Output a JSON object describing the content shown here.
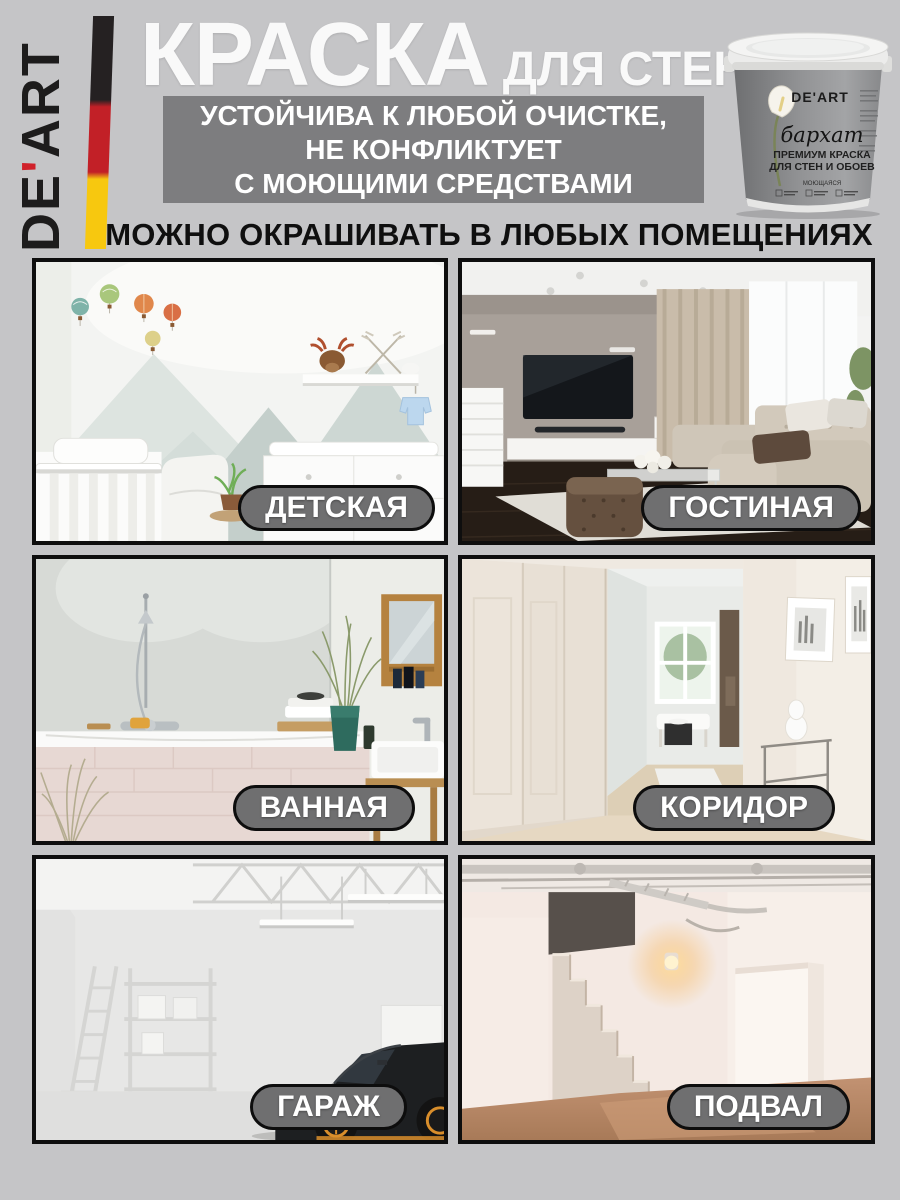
{
  "page": {
    "background": "#c5c5c7"
  },
  "logo": {
    "part1": "DE",
    "apostrophe": "'",
    "part2": "ART",
    "flag_colors": {
      "black": "#252122",
      "red": "#c22027",
      "yellow": "#f7c80f"
    }
  },
  "header": {
    "title": "КРАСКА",
    "title_suffix": "ДЛЯ СТЕН",
    "benefit_box": {
      "background": "#7d7d7f",
      "lines": [
        "УСТОЙЧИВА К ЛЮБОЙ ОЧИСТКЕ,",
        "НЕ КОНФЛИКТУЕТ",
        "С МОЮЩИМИ СРЕДСТВАМИ"
      ]
    },
    "section_heading": "МОЖНО ОКРАШИВАТЬ В ЛЮБЫХ ПОМЕЩЕНИЯХ"
  },
  "bucket": {
    "brand": "DE'ART",
    "series": "бархат",
    "type_line": "ПРЕМИУМ КРАСКА",
    "application_line": "ДЛЯ СТЕН И ОБОЕВ",
    "feature": "МОЮЩАЯСЯ"
  },
  "rooms": [
    {
      "label": "ДЕТСКАЯ",
      "scene": "nursery"
    },
    {
      "label": "ГОСТИНАЯ",
      "scene": "living-room"
    },
    {
      "label": "ВАННАЯ",
      "scene": "bathroom"
    },
    {
      "label": "КОРИДОР",
      "scene": "corridor"
    },
    {
      "label": "ГАРАЖ",
      "scene": "garage"
    },
    {
      "label": "ПОДВАЛ",
      "scene": "basement"
    }
  ],
  "label_pill": {
    "background": "#6f6f70",
    "border": "#0d0d0d",
    "text_color": "#ffffff"
  }
}
